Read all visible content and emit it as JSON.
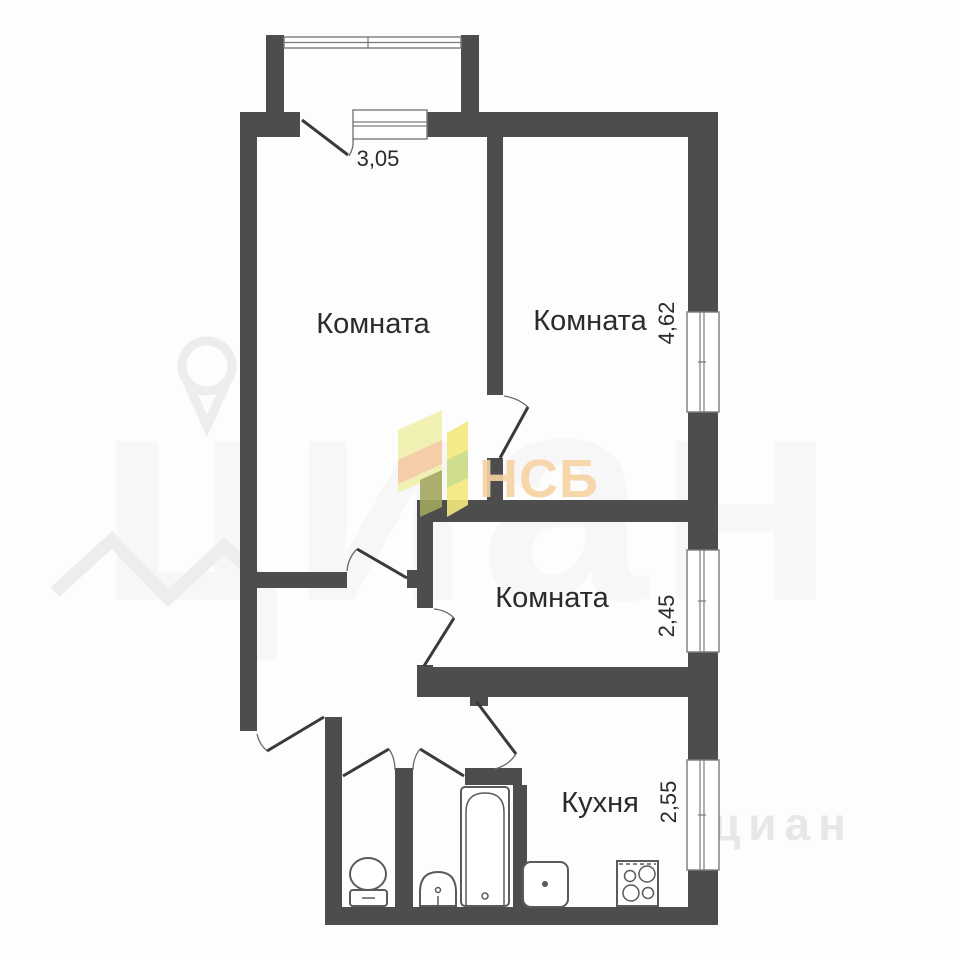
{
  "floorplan": {
    "rooms": {
      "room_top_left": {
        "label": "Комната"
      },
      "room_top_right": {
        "label": "Комната",
        "dimension": "4,62"
      },
      "room_middle": {
        "label": "Комната",
        "dimension": "2,45"
      },
      "kitchen": {
        "label": "Кухня",
        "dimension": "2,55"
      }
    },
    "balcony": {
      "width_dimension": "3,05"
    },
    "fixtures": [
      "toilet",
      "washbasin",
      "bathtub",
      "kitchen-sink",
      "stove"
    ]
  },
  "watermarks": {
    "agency_logo_text": "НСБ",
    "site_watermark_large": "циан",
    "site_watermark_small": "циан"
  },
  "colors": {
    "wall": "#4d4d4d",
    "label_text": "#2b2b2b",
    "logo_text": "#f6d3a2",
    "logo_pale_yellow": "#eff0ab",
    "logo_yellow": "#f5e97e",
    "logo_orange": "#f5c9a0",
    "logo_green": "#cadb80",
    "logo_olive": "#a3a75e"
  }
}
